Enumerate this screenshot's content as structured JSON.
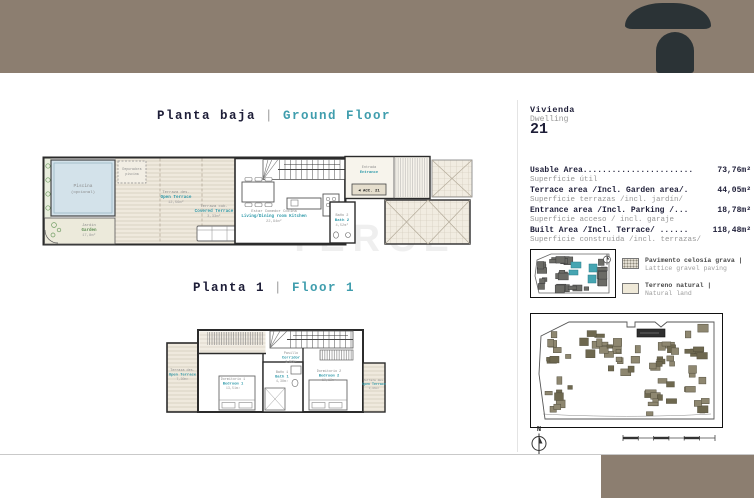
{
  "colors": {
    "header_bg": "#8c7e70",
    "logo": "#2b3336",
    "accent_teal": "#2f9aaa",
    "text_dark": "#1e1e38",
    "text_gray": "#979797",
    "site_building": "#8e8770",
    "highlight_unit": "#2f2f2f",
    "keyplan_highlight": "#46a5b2"
  },
  "titles": {
    "ground": {
      "es": "Planta baja",
      "sep": "|",
      "en": "Ground Floor"
    },
    "first": {
      "es": "Planta 1",
      "sep": "|",
      "en": "Floor 1"
    }
  },
  "dwelling": {
    "label_es": "Vivienda",
    "label_en": "Dwelling",
    "number": "21"
  },
  "areas": [
    {
      "en": "Usable Area.......................",
      "value": "73,76m²",
      "es": "Superficie útil"
    },
    {
      "en": "Terrace area /Incl. Garden area/.",
      "value": "44,05m²",
      "es": "Superficie terrazas /incl. jardín/"
    },
    {
      "en": "Entrance area /Incl. Parking /...",
      "value": "18,78m²",
      "es": "Superficie acceso / incl. garaje"
    },
    {
      "en": "Built Area /Incl. Terrace/ ......",
      "value": "118,48m²",
      "es": "Superficie construida /incl. terrazas/"
    }
  ],
  "legend": [
    {
      "es": "Pavimento celosía grava |",
      "en": "Lattice gravel paving"
    },
    {
      "es": "Terreno natural |",
      "en": "Natural land"
    }
  ],
  "ground_floor": {
    "pool_line1": "Piscina",
    "pool_line2": "(opcional)",
    "pool_equip_line1": "Depuradora",
    "pool_equip_line2": "piscina",
    "garden": {
      "es": "Jardín",
      "en": "Garden",
      "area": "17,8m²"
    },
    "open_terrace": {
      "es": "Terraza des.",
      "en": "Open Terrace",
      "area": "12,56m²"
    },
    "covered_terrace": {
      "es": "Terraza cub.",
      "en": "Covered Terrace",
      "area": "3,33m²"
    },
    "living": {
      "es": "Estar Comedor Cocina",
      "en": "Living/Dining room Kitchen",
      "area": "22,94m²"
    },
    "bath2": {
      "es": "Baño 2",
      "en": "Bath 2",
      "area": "4,52m²"
    },
    "entrance": {
      "es": "Entrada",
      "en": "Entrance"
    },
    "access_tag": "◄ ACC. 21"
  },
  "first_floor": {
    "terrace_left": {
      "es": "Terraza des.",
      "en": "Open Terrace",
      "area": "7,30m²"
    },
    "bedroom1": {
      "es": "Dormitorio 1",
      "en": "Bedroom 1",
      "area": "13,51m²"
    },
    "corridor": {
      "es": "Pasillo",
      "en": "Corridor",
      "area": "1,92m²"
    },
    "bath1": {
      "es": "Baño 1",
      "en": "Bath 1",
      "area": "4,38m²"
    },
    "bedroom2": {
      "es": "Dormitorio 2",
      "en": "Bedroom 2",
      "area": "10,13m²"
    },
    "terrace_right": {
      "es": "Terraza des.",
      "en": "Open Terrace",
      "area": "3,06m²"
    }
  },
  "compass": {
    "label": "N"
  },
  "watermark": "TERCE"
}
